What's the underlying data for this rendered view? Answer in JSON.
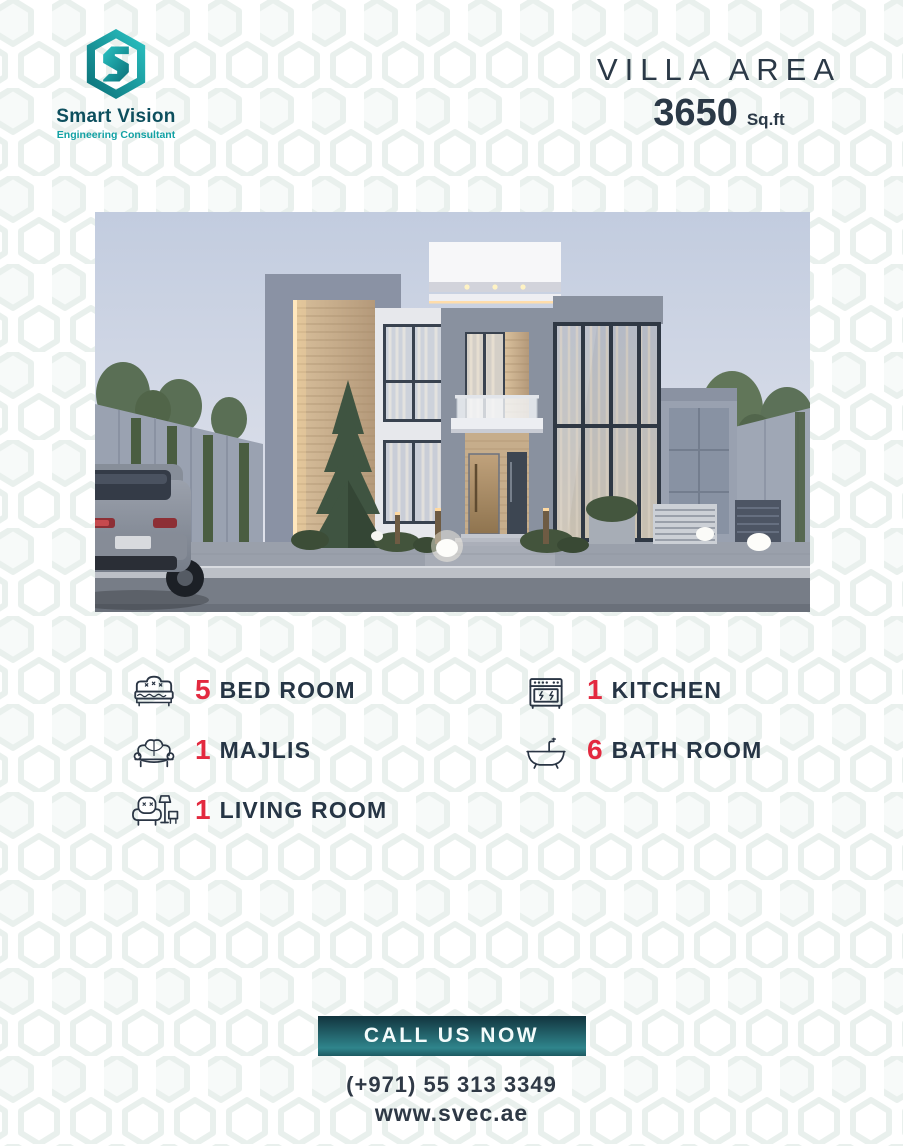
{
  "brand": {
    "name": "Smart Vision",
    "tagline": "Engineering Consultant",
    "logo_icon": "hexagon-s-monogram",
    "teal_dark": "#0d4f5e",
    "teal_light": "#12a1a4"
  },
  "header": {
    "area_label": "VILLA AREA",
    "area_value": "3650",
    "area_unit": "Sq.ft"
  },
  "hero": {
    "description": "3D render of a modern two-storey villa at dusk: grey stone frames, wooden slat accents with warm LED strips, large glass curtain wall, central entrance with wooden door, balcony, conifer tree, boundary walls with hedges and trees, glowing garden lamps, grey SUV parked at left"
  },
  "features": [
    {
      "icon": "bed-icon",
      "count": "5",
      "label": "BED ROOM"
    },
    {
      "icon": "stove-icon",
      "count": "1",
      "label": "KITCHEN"
    },
    {
      "icon": "sofa-icon",
      "count": "1",
      "label": "MAJLIS"
    },
    {
      "icon": "bathtub-icon",
      "count": "6",
      "label": "BATH ROOM"
    },
    {
      "icon": "armchair-icon",
      "count": "1",
      "label": "LIVING ROOM"
    }
  ],
  "cta": {
    "button_label": "CALL US NOW",
    "phone": "(+971) 55 313 3349",
    "website": "www.svec.ae"
  },
  "colors": {
    "accent_red": "#e3293f",
    "text_navy": "#263545",
    "button_gradient_top": "#12343e",
    "button_gradient_bottom": "#2f858c",
    "pattern_tint": "#e9f0ed"
  }
}
